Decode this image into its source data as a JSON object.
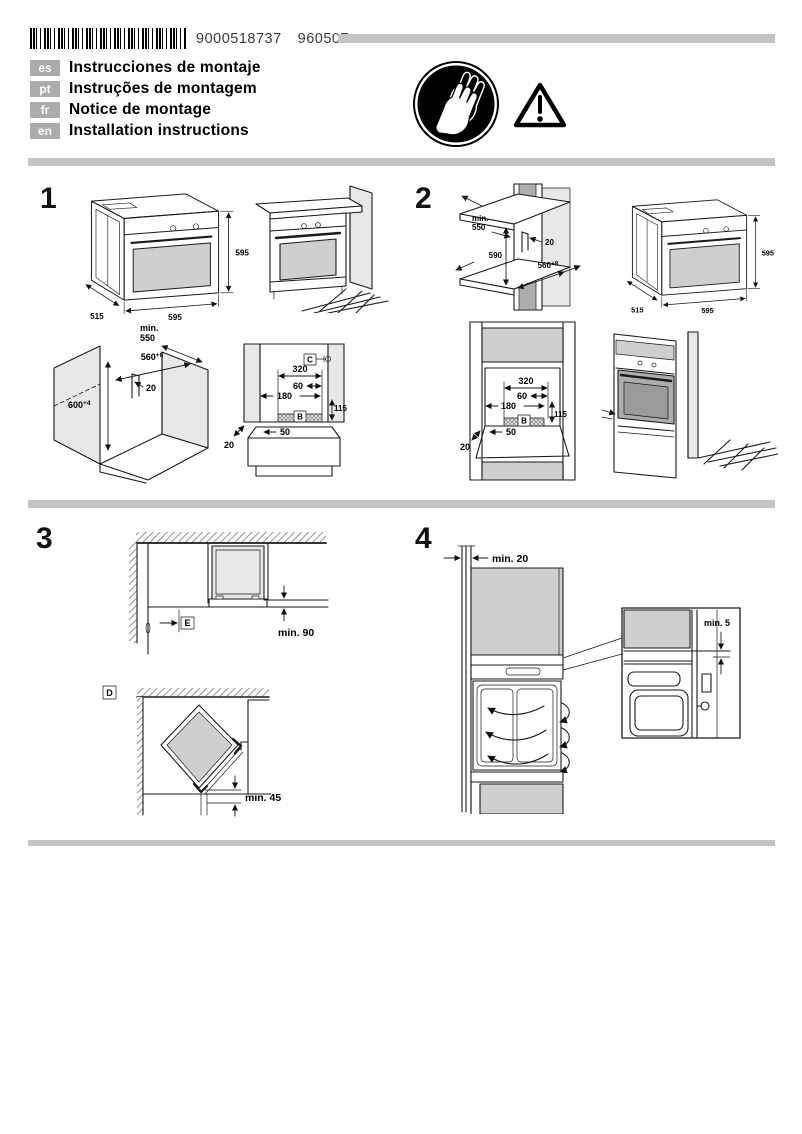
{
  "header": {
    "part_number": "9000518737",
    "revision": "960507",
    "languages": [
      {
        "code": "es",
        "title": "Instrucciones de montaje"
      },
      {
        "code": "pt",
        "title": "Instruções de montagem"
      },
      {
        "code": "fr",
        "title": "Notice de montage"
      },
      {
        "code": "en",
        "title": "Installation instructions"
      }
    ]
  },
  "icons": {
    "gloves": "protective-gloves-icon",
    "warning": "warning-triangle-icon"
  },
  "s1": {
    "num": "1",
    "oven": {
      "height": "595",
      "width": "595",
      "depth": "515"
    },
    "cab": {
      "min_label": "min.",
      "min_value": "550",
      "recess_w": "560",
      "recess_w_sup": "+8",
      "recess_h": "600",
      "recess_h_sup": "+4",
      "gap": "20"
    },
    "niche": {
      "c": "C",
      "b": "B",
      "w320": "320",
      "w60": "60",
      "w180": "180",
      "h115": "115",
      "w50": "50",
      "g20": "20"
    }
  },
  "s2": {
    "num": "2",
    "cab": {
      "min_label": "min.",
      "min_value": "550",
      "height": "590",
      "gap": "20",
      "recess_w": "560",
      "recess_w_sup": "+8"
    },
    "oven": {
      "height": "595",
      "width": "595",
      "depth": "515"
    },
    "niche": {
      "b": "B",
      "w320": "320",
      "w60": "60",
      "w180": "180",
      "h115": "115",
      "w50": "50",
      "g20": "20"
    }
  },
  "s3": {
    "num": "3",
    "e": "E",
    "min90": "min. 90",
    "d": "D",
    "min45": "min. 45"
  },
  "s4": {
    "num": "4",
    "min20": "min. 20",
    "min5": "min. 5"
  }
}
